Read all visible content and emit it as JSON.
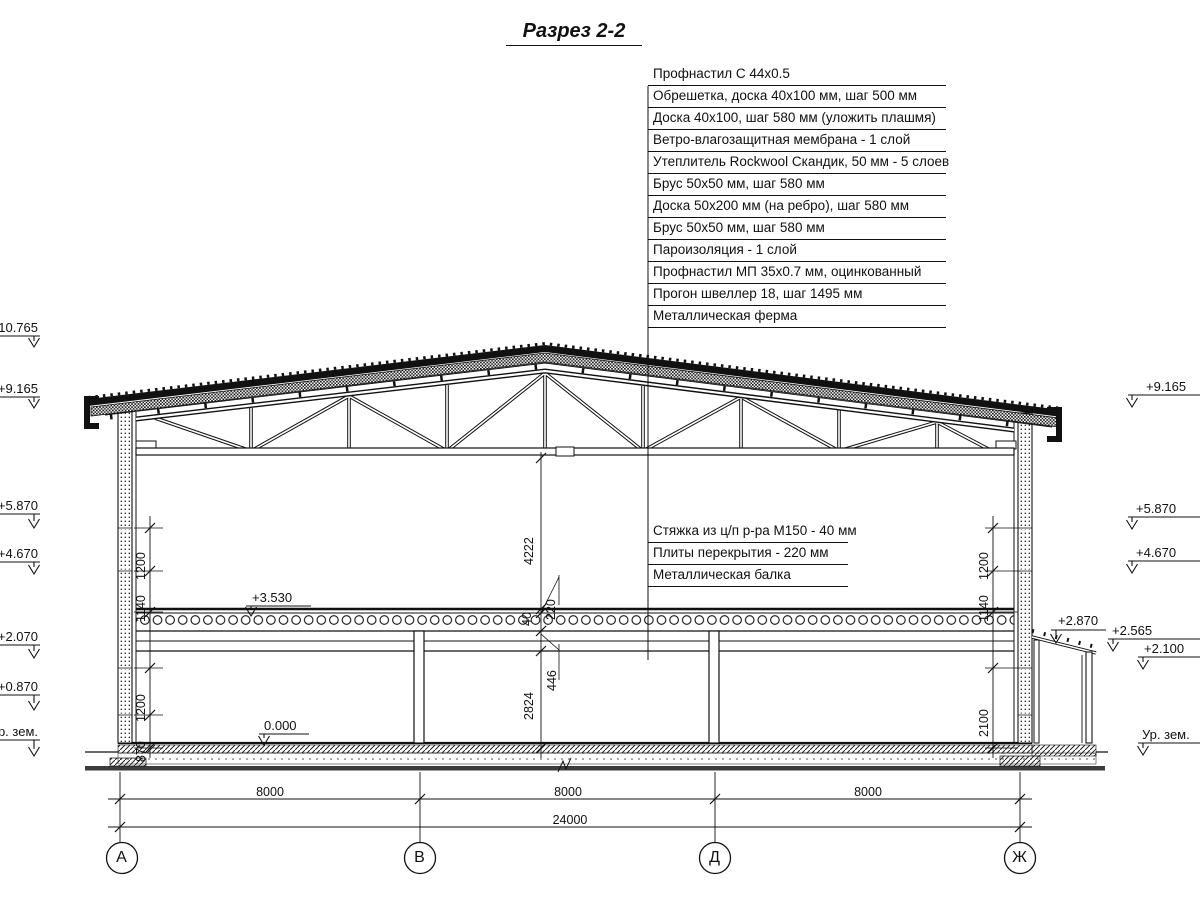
{
  "title": "Разрез 2-2",
  "roof_callouts": [
    "Профнастил С 44х0.5",
    "Обрешетка, доска 40х100 мм, шаг 500 мм",
    "Доска 40х100, шаг 580 мм (уложить плашмя)",
    "Ветро-влагозащитная мембрана - 1 слой",
    "Утеплитель Rockwool Скандик, 50 мм - 5 слоев",
    "Брус 50х50 мм, шаг 580 мм",
    "Доска 50х200 мм (на ребро), шаг 580 мм",
    "Брус 50х50 мм, шаг 580 мм",
    "Пароизоляция - 1 слой",
    "Профнастил МП 35х0.7 мм, оцинкованный",
    "Прогон швеллер 18, шаг 1495 мм",
    "Металлическая ферма"
  ],
  "floor_callouts": [
    "Стяжка из ц/п р-ра М150 - 40 мм",
    "Плиты перекрытия - 220 мм",
    "Металлическая балка"
  ],
  "elevations": {
    "left": [
      "+10.765",
      "+9.165",
      "+5.870",
      "+4.670",
      "+2.070",
      "+0.870",
      "Ур. зем."
    ],
    "right": [
      "+9.165",
      "+5.870",
      "+4.670",
      "+2.870",
      "+2.565",
      "+2.100",
      "Ур. зем."
    ],
    "floor_zero": "0.000",
    "slab_top": "+3.530"
  },
  "dimensions": {
    "left_chain": [
      "1200",
      "1140",
      "1200",
      "870"
    ],
    "right_chain": [
      "1200",
      "1140",
      "2100"
    ],
    "center_chain": [
      "4222",
      "40",
      "220",
      "446",
      "2824"
    ],
    "spans": [
      "8000",
      "8000",
      "8000"
    ],
    "total": "24000"
  },
  "axes": [
    "А",
    "В",
    "Д",
    "Ж"
  ]
}
